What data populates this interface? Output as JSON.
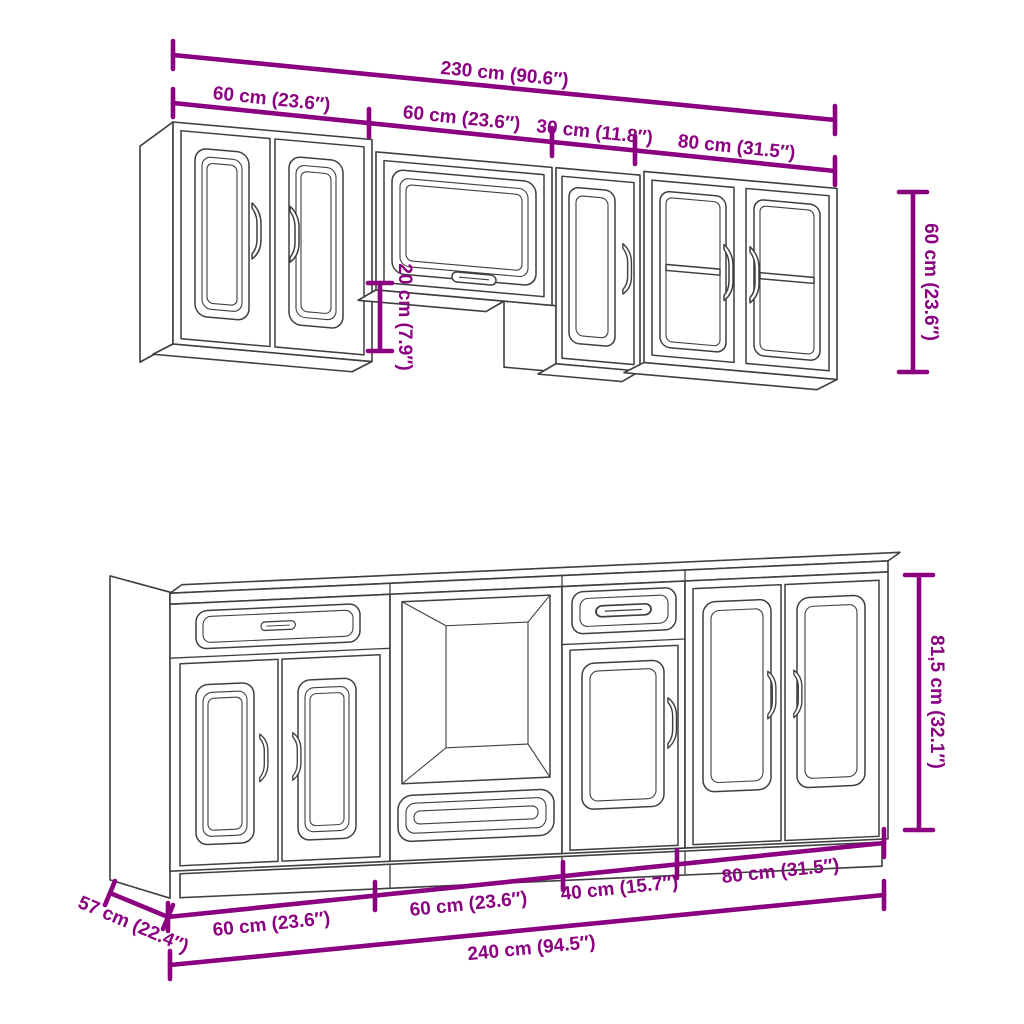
{
  "diagram": {
    "background_color": "#ffffff",
    "drawing_line_color": "#3f3f3f",
    "dimension_color": "#8a0080"
  },
  "wall_cabinets": {
    "overall_width_label": "230 cm (90.6″)",
    "segment_labels": [
      "60 cm (23.6″)",
      "60 cm (23.6″)",
      "30 cm (11.8″)",
      "80 cm (31.5″)"
    ],
    "height_label": "60 cm (23.6″)",
    "offset_label": "20 cm (7.9″)"
  },
  "base_cabinets": {
    "overall_width_label": "240 cm (94.5″)",
    "segment_labels": [
      "60 cm (23.6″)",
      "60 cm (23.6″)",
      "40 cm (15.7″)",
      "80 cm (31.5″)"
    ],
    "height_label": "81,5 cm (32.1″)",
    "depth_label": "57 cm (22.4″)"
  }
}
